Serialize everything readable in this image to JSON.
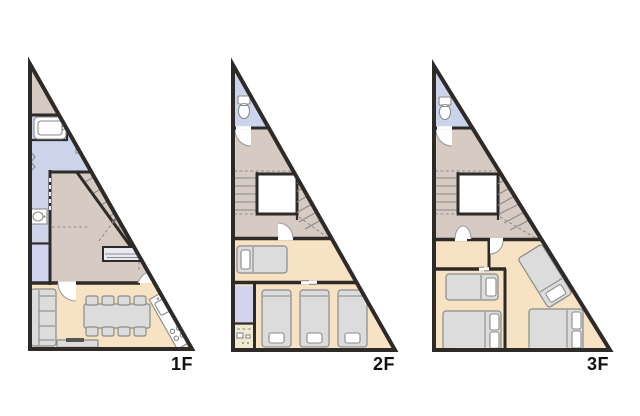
{
  "canvas": {
    "width": 640,
    "height": 416
  },
  "colors": {
    "bg": "#ffffff",
    "wall": "#2e2a28",
    "room-beige": "#d7cac2",
    "room-blue": "#ccd4ec",
    "room-lavender": "#d2d3ef",
    "room-peach": "#f7e2c3",
    "room-cream": "#edead0",
    "furniture-fill": "#dcdcdc",
    "furniture-stroke": "#8a8a8a",
    "outline-gray": "#8a8a8a",
    "label-ink": "#111111"
  },
  "floors": [
    {
      "id": "1f",
      "label": "1F",
      "rooms": [
        "upper-hall",
        "bathroom",
        "washroom",
        "closet",
        "hallway",
        "entrance",
        "living-dining-kitchen"
      ],
      "furniture_icons": [
        "bathtub-icon",
        "shower-faucet-icon",
        "washbasin-icon",
        "staircase-icon",
        "shoe-cabinet-icon",
        "sofa-icon",
        "dining-table-icon",
        "dining-chair-icon",
        "kitchen-counter-icon",
        "tv-board-icon"
      ]
    },
    {
      "id": "2f",
      "label": "2F",
      "rooms": [
        "toilet",
        "hallway",
        "stairwell",
        "bedroom-single",
        "closet",
        "storage",
        "bedroom-triple"
      ],
      "furniture_icons": [
        "toilet-icon",
        "staircase-icon",
        "single-bed-icon",
        "single-bed-icon",
        "single-bed-icon",
        "single-bed-icon",
        "storage-fixtures-icon"
      ]
    },
    {
      "id": "3f",
      "label": "3F",
      "rooms": [
        "toilet",
        "hallway",
        "stairwell",
        "bedroom-left",
        "bedroom-right"
      ],
      "furniture_icons": [
        "toilet-icon",
        "staircase-icon",
        "single-bed-icon",
        "double-bed-icon",
        "diagonal-bed-icon",
        "double-bed-icon"
      ]
    }
  ]
}
